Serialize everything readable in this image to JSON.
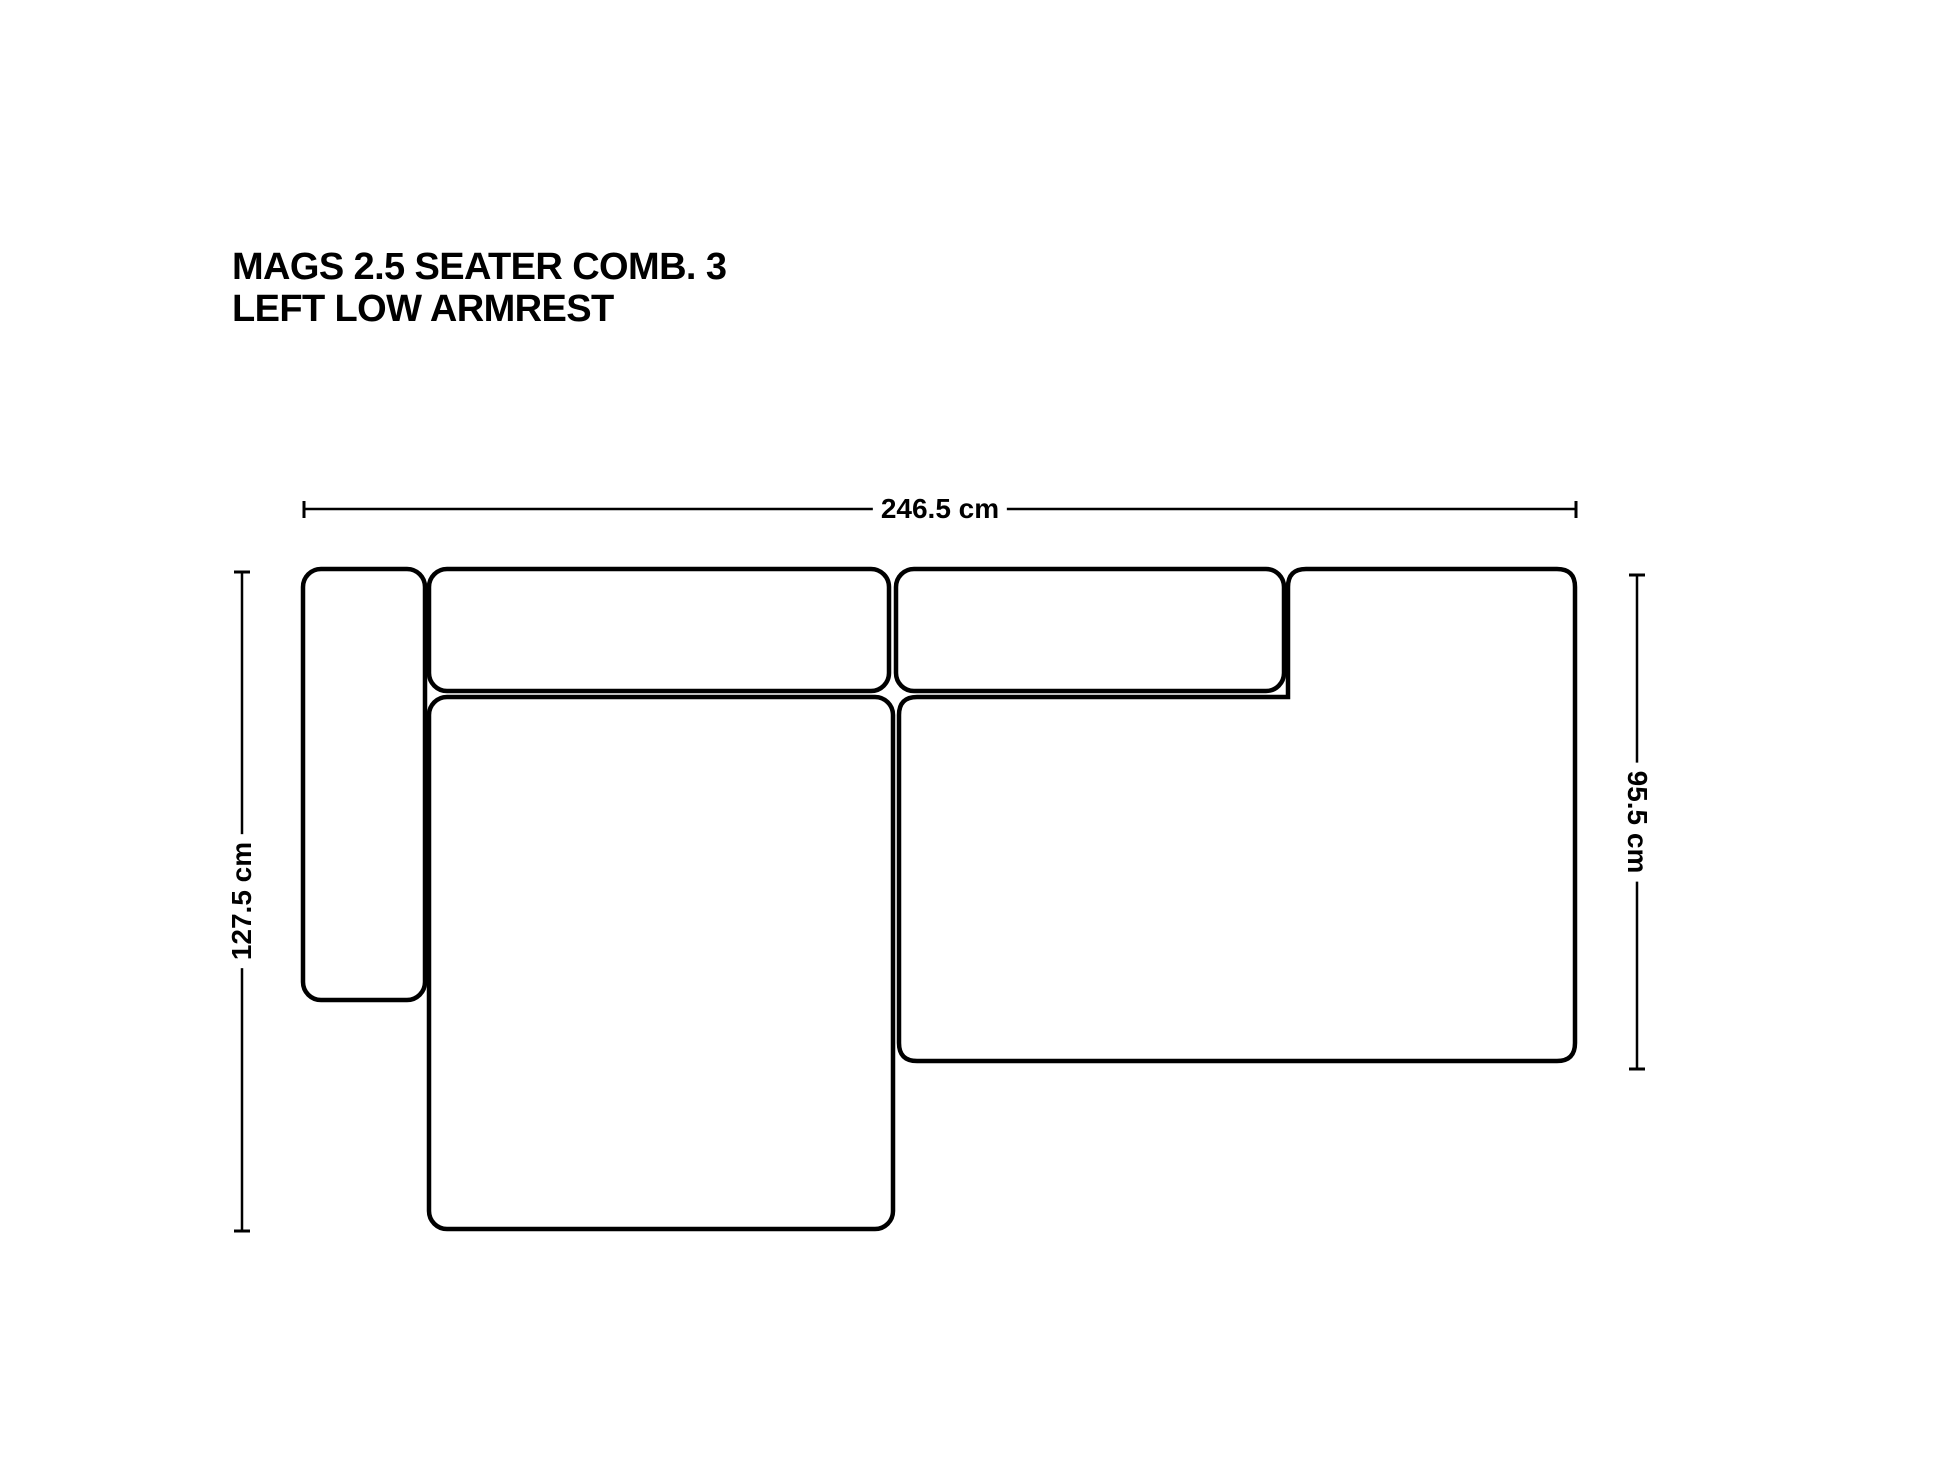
{
  "title": {
    "line1": "MAGS 2.5 SEATER COMB. 3",
    "line2": "LEFT LOW ARMREST"
  },
  "dimensions": {
    "overall_width": "246.5 cm",
    "overall_depth": "127.5 cm",
    "seat_depth": "95.5 cm"
  },
  "colors": {
    "line": "#000000",
    "background": "#ffffff"
  }
}
